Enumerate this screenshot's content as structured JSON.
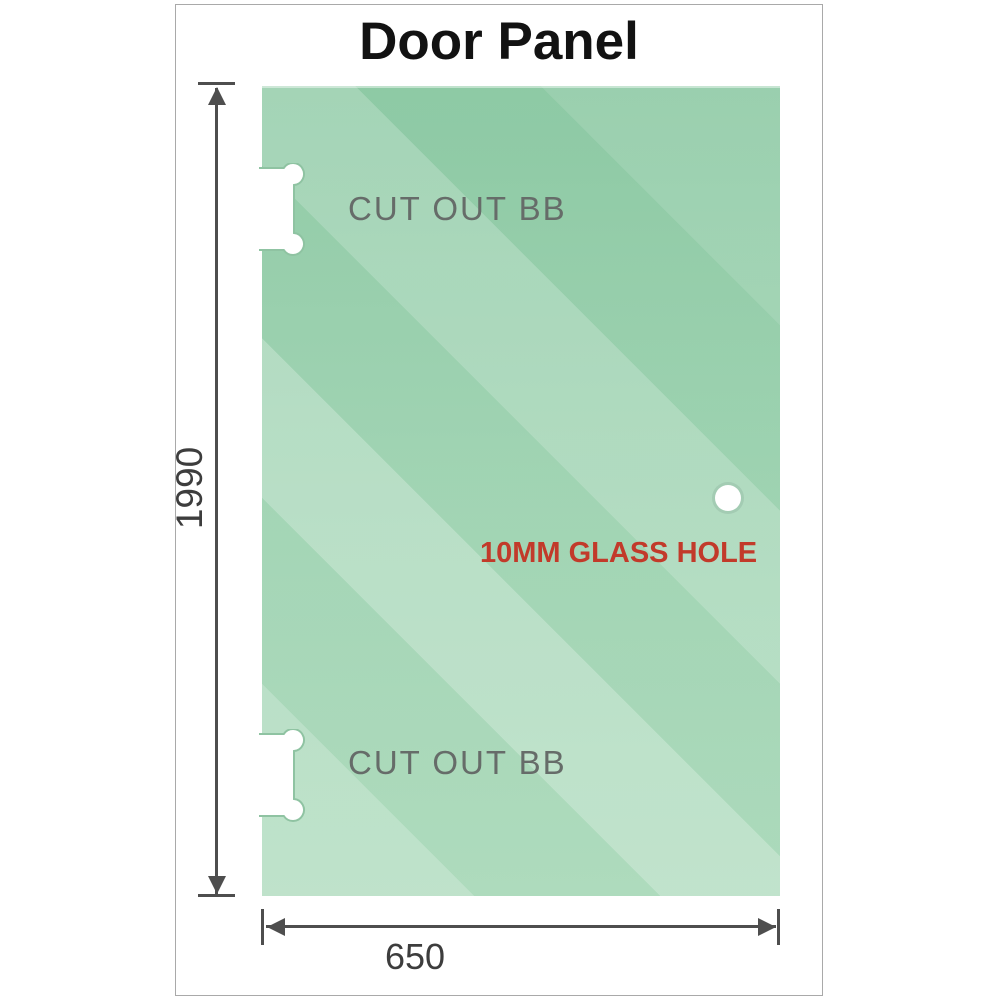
{
  "title": "Door Panel",
  "panel": {
    "description": "green glass door panel",
    "cutouts": [
      {
        "label": "CUT OUT BB",
        "position": "top-left-edge"
      },
      {
        "label": "CUT OUT BB",
        "position": "bottom-left-edge"
      }
    ],
    "glass_hole": {
      "label": "10MM GLASS HOLE",
      "position": "middle-right"
    }
  },
  "dimensions": {
    "height": "1990",
    "width": "650"
  },
  "colors": {
    "glass_base": "#8cc9a2",
    "glass_light": "#b7e0c6",
    "dimension_lines": "#4e4e4e",
    "dimension_text": "#3d3d3d",
    "cutout_label_text": "#666c69",
    "glass_hole_label_text": "#c23a2a",
    "title_text": "#121212",
    "frame_border": "#a9a9a9"
  }
}
